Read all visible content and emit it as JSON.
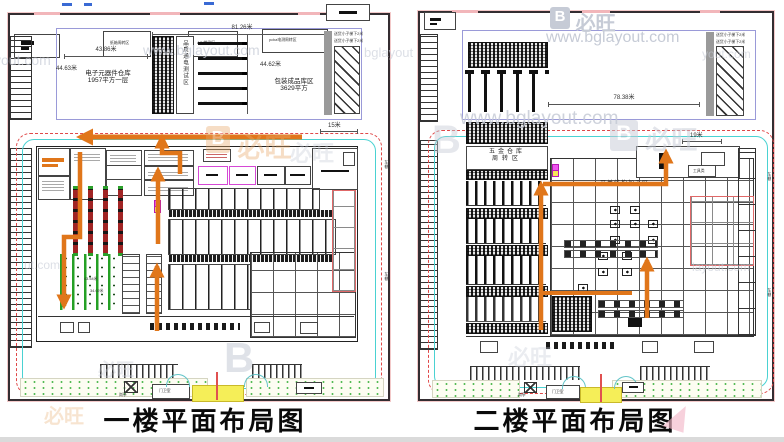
{
  "watermark": {
    "brand": "必旺",
    "site": "www.bglayout.com",
    "logo_letter": "B",
    "frag_yout": "yout.com",
    "frag_ut": "ut.com",
    "frag_layout": "layout.com",
    "frag_bglayout": "bglayout"
  },
  "colors": {
    "flow_orange": "#e0761a",
    "boundary_red": "#e04848",
    "inner_cyan": "#4ad2d2",
    "zone_magenta": "#ee55ee",
    "gate_yellow": "#f5ee58",
    "plan_blue": "#9a9ad8"
  },
  "floor1": {
    "caption": "一楼平面布局图",
    "top_boxes": {
      "b1": "纸箱周转区",
      "b2": "AOI检测区",
      "b3": "pcba电测周转区"
    },
    "warehouse": {
      "dim_total": "81.26米",
      "dim_w": "43.86米",
      "dim_h": "44.63米",
      "room1_l1": "电子元器件仓库",
      "room1_l2": "1957平方一层",
      "test_zone": "品质通电测试区",
      "dim_h2": "44.62米",
      "room2_l1": "包装成品库区",
      "room2_l2": "3629平方",
      "lift_note": "送货小子梯下2米"
    },
    "dims": {
      "road": "15米",
      "a": "43.54米",
      "b": "34.02米"
    },
    "site": {
      "guard": "岗亭",
      "gate_room": "门卫室",
      "edge": "车棚"
    }
  },
  "floor2": {
    "caption": "二楼平面布局图",
    "warehouse": {
      "dim_total": "78.38米",
      "lift_note": "送货小子梯下2米"
    },
    "dims": {
      "road": "19米"
    },
    "hall": {
      "store_l1": "五金仓库",
      "store_l2": "周转区",
      "zone": "开关结构加工区",
      "tools": "工具类"
    },
    "site": {
      "guard": "岗亭",
      "gate_room": "门卫室",
      "edge": "车棚"
    }
  }
}
